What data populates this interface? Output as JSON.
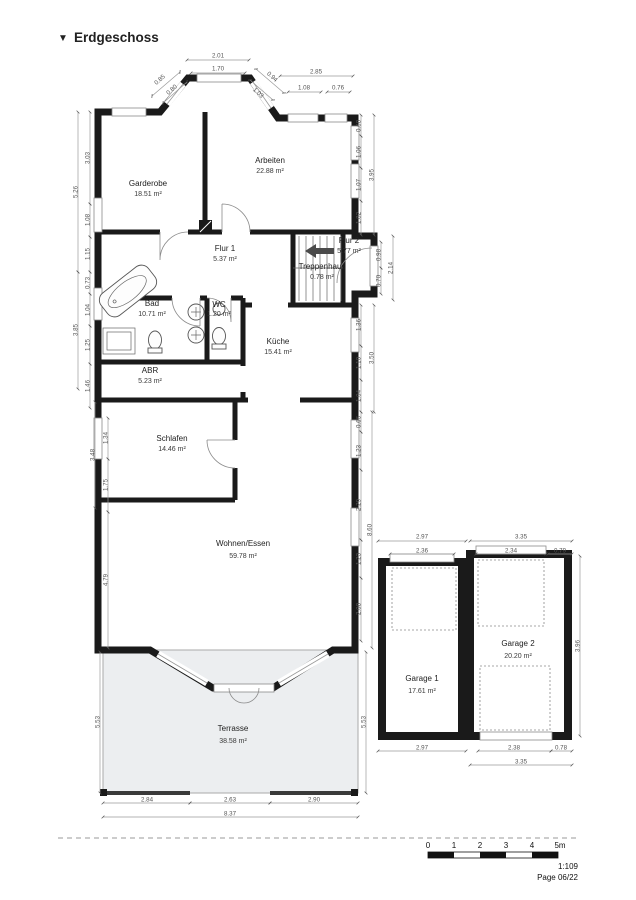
{
  "header": {
    "marker": "▼",
    "title": "Erdgeschoss"
  },
  "rooms": [
    {
      "name": "Garderobe",
      "area": "18.51 m²"
    },
    {
      "name": "Arbeiten",
      "area": "22.88 m²"
    },
    {
      "name": "Flur 1",
      "area": "5.37 m²"
    },
    {
      "name": "Flur 2",
      "area": "5.77 m²"
    },
    {
      "name": "Treppenhaus",
      "area": "0.78 m²"
    },
    {
      "name": "Bad",
      "area": "10.71 m²"
    },
    {
      "name": "WC",
      "area": "1.20 m²"
    },
    {
      "name": "Küche",
      "area": "15.41 m²"
    },
    {
      "name": "ABR",
      "area": "5.23 m²"
    },
    {
      "name": "Schlafen",
      "area": "14.46 m²"
    },
    {
      "name": "Wohnen/Essen",
      "area": "59.78 m²"
    },
    {
      "name": "Terrasse",
      "area": "38.58 m²"
    },
    {
      "name": "Garage 1",
      "area": "17.61 m²"
    },
    {
      "name": "Garage 2",
      "area": "20.20 m²"
    }
  ],
  "dims": {
    "top": [
      "2.01",
      "1.70",
      "2.85",
      "1.08",
      "0.76",
      "0.85",
      "0.80",
      "0.94",
      "1.03"
    ],
    "right": [
      "0.68",
      "1.06",
      "1.07",
      "1.82",
      "3.95",
      "0.98",
      "0.70",
      "2.14",
      "1.36",
      "1.10",
      "1.04",
      "3.50",
      "0.66",
      "1.23",
      "2.29",
      "1.23",
      "2.08",
      "8.60",
      "5.53",
      "3.96"
    ],
    "left": [
      "3.03",
      "1.08",
      "1.15",
      "5.26",
      "0.73",
      "1.04",
      "1.25",
      "3.85",
      "1.46",
      "1.34",
      "1.75",
      "3.48",
      "4.79",
      "5.53"
    ],
    "bottom": [
      "2.84",
      "2.63",
      "2.90",
      "8.37"
    ],
    "garage": [
      "2.97",
      "3.35",
      "2.36",
      "2.34",
      "0.79",
      "2.97",
      "2.38",
      "0.78",
      "3.35"
    ]
  },
  "scalebar": {
    "t0": "0",
    "t1": "1",
    "t2": "2",
    "t3": "3",
    "t4": "4",
    "t5": "5m",
    "ratio": "1:109",
    "page": "Page 06/22"
  }
}
